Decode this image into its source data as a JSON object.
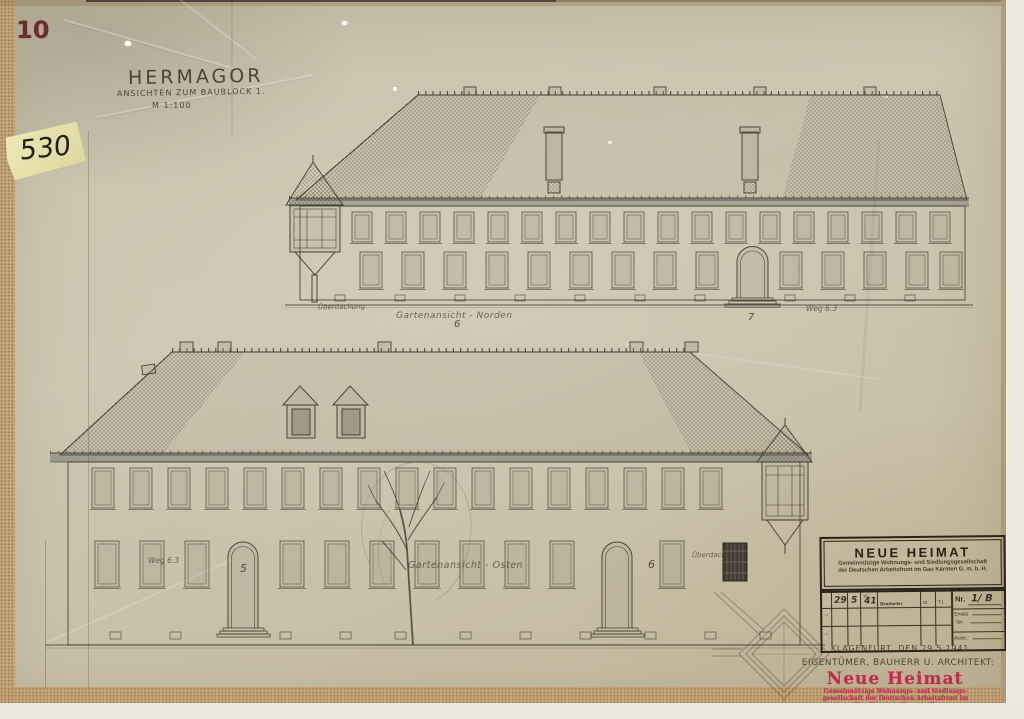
{
  "page": {
    "corner_number": "10",
    "sticky_note": "530"
  },
  "title_block": {
    "title": "HERMAGOR",
    "subtitle": "ANSICHTEN ZUM BAUBLOCK 1.",
    "scale": "M 1:100"
  },
  "top_elevation": {
    "label_left": "Überdachung",
    "caption": "Gartenansicht - Norden",
    "number_center": "6",
    "number_right": "7",
    "label_right": "Weg 6.3"
  },
  "bottom_elevation": {
    "label_left": "Weg 6.3",
    "number_left": "5",
    "caption": "Gartenansicht - Osten",
    "number_right": "6",
    "label_right": "Überdachung"
  },
  "stamp": {
    "company": "NEUE HEIMAT",
    "subline1": "Gemeinnützige Wohnungs- und Siedlungsgesellschaft",
    "subline2": "der Deutschen Arbeitsfront im Gau Kärnten G. m. b. H.",
    "table": {
      "day": "29",
      "month": "5",
      "year_prefix": "19",
      "year": "41",
      "bearbeiter": "Bearbeiter",
      "m": "m.",
      "ti": "T.I.",
      "nr_label": "Nr.",
      "nr_value": "1/ B",
      "ersatz": "Ersatz",
      "fuer": "für:",
      "ausb": "Ausb.:",
      "arrow": "→"
    }
  },
  "footer": {
    "place_date": "KLAGENFURT, DEN 29.5.1941",
    "owner": "EIGENTÜMER, BAUHERR U. ARCHITEKT:",
    "company": "Neue Heimat",
    "line1": "Gemeinnützige Wohnungs- und Siedlungs-",
    "line2": "gesellschaft der Deutschen Arbeitsfront im",
    "line3": "Gau Kärnten, G. m. b. H."
  },
  "colors": {
    "paper": "#cbc3ad",
    "edge_tan": "#c7a679",
    "ink": "#352e24",
    "pencil": "#6f6656",
    "stamp_red": "#c02b4e",
    "corner_red": "#6e2d2d",
    "note_yellow": "#eae5ae"
  }
}
